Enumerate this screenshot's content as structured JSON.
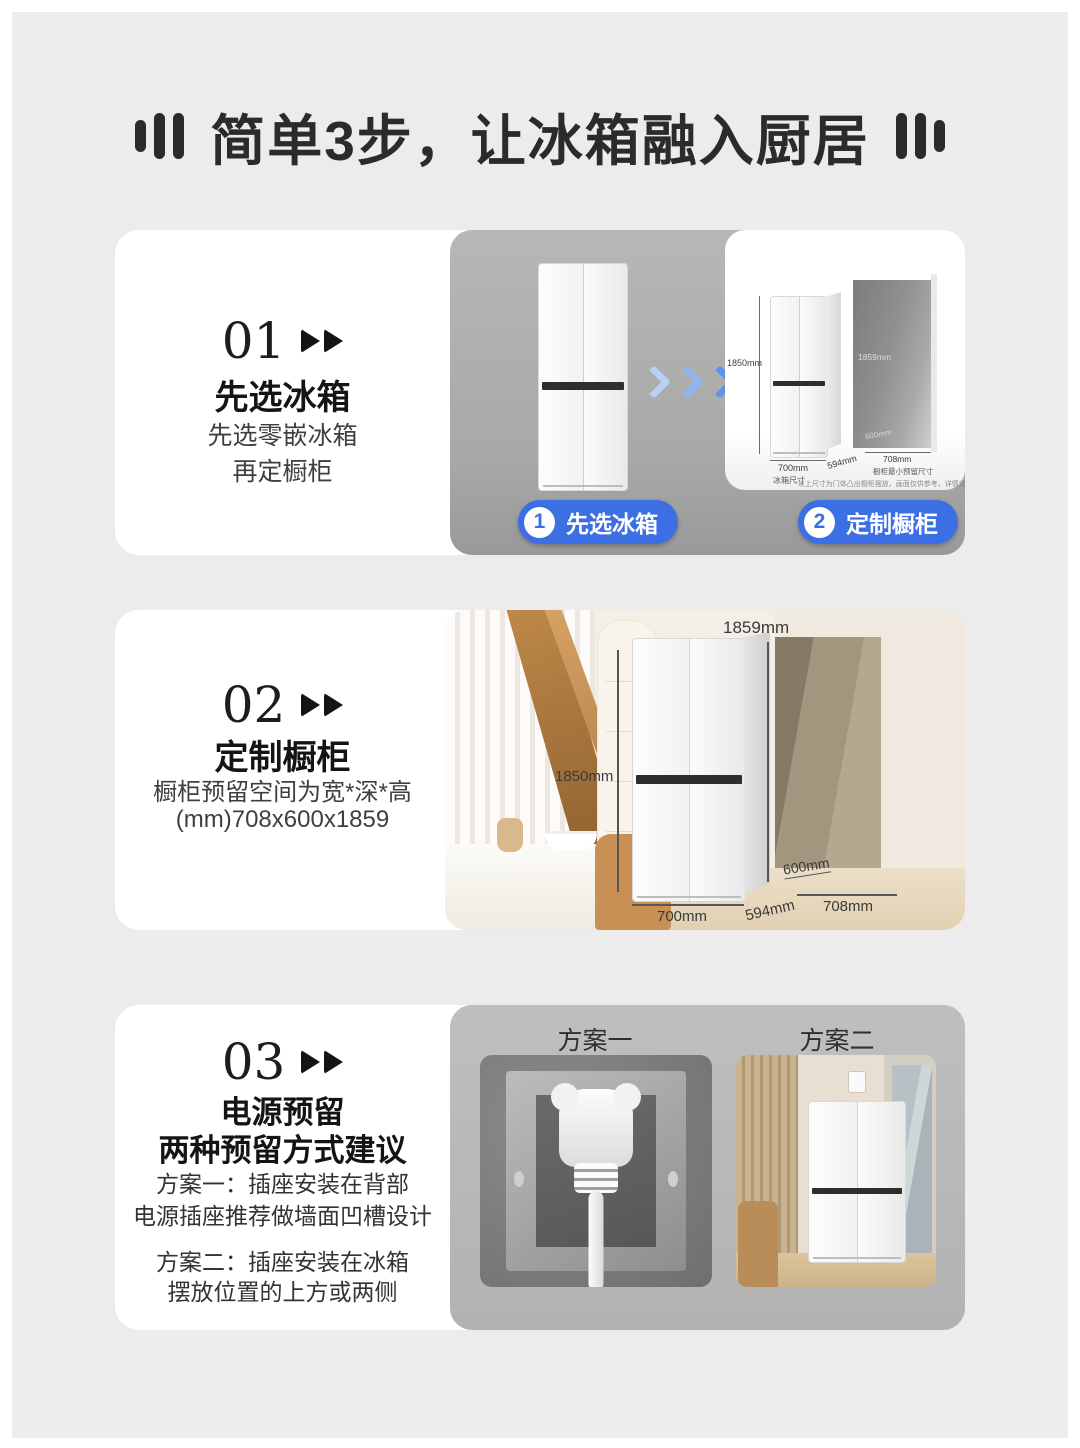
{
  "title": {
    "text": "简单3步，让冰箱融入厨居"
  },
  "colors": {
    "accent_blue": "#3D6FE4",
    "page_bg": "#ECECEC",
    "chevron_blue": "#2E6FE8"
  },
  "steps": [
    {
      "number": "01",
      "heading": "先选冰箱",
      "line1": "先选零嵌冰箱",
      "line2": "再定橱柜",
      "badge1": {
        "num": "1",
        "label": "先选冰箱"
      },
      "badge2": {
        "num": "2",
        "label": "定制橱柜"
      },
      "diagram": {
        "fridge_height": "1850mm",
        "fridge_width": "700mm",
        "fridge_depth": "594mm",
        "fridge_label": "冰箱尺寸",
        "recess_height": "1859mm",
        "recess_depth": "600mm",
        "recess_width": "708mm",
        "recess_label": "橱柜最小预留尺寸",
        "footnote": "*以上尺寸为门体凸出橱柜摆放，画面仅供参考，详情请以实物为准"
      }
    },
    {
      "number": "02",
      "heading": "定制橱柜",
      "line1": "橱柜预留空间为宽*深*高",
      "line2": "(mm)708x600x1859",
      "scene": {
        "fridge_height": "1850mm",
        "fridge_width": "700mm",
        "fridge_depth": "594mm",
        "recess_height": "1859mm",
        "recess_depth": "600mm",
        "recess_width": "708mm"
      }
    },
    {
      "number": "03",
      "heading": "电源预留",
      "subheading": "两种预留方式建议",
      "line1": "方案一：插座安装在背部",
      "line2": "电源插座推荐做墙面凹槽设计",
      "line3": "方案二：插座安装在冰箱",
      "line4": "摆放位置的上方或两侧",
      "plan1_label": "方案一",
      "plan2_label": "方案二"
    }
  ]
}
